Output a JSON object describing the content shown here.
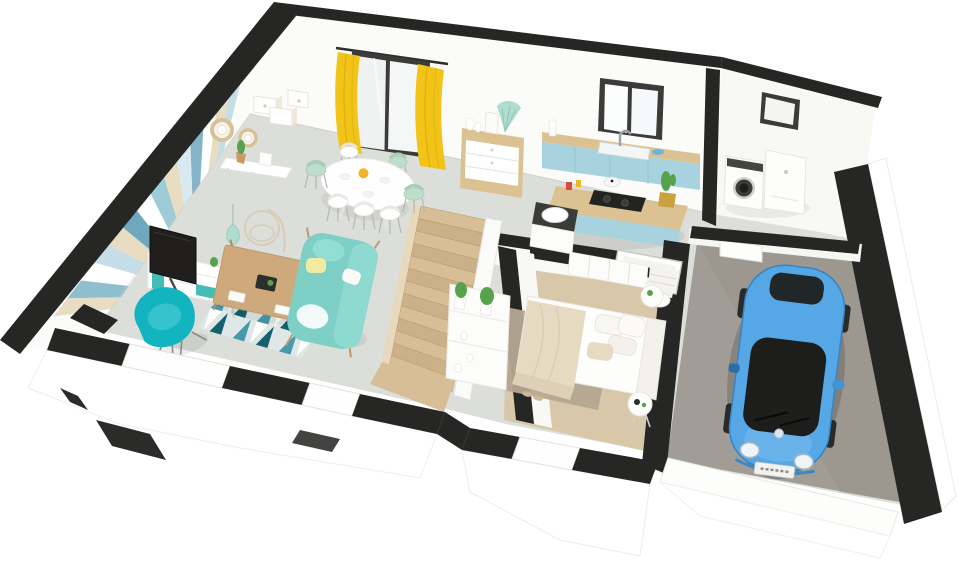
{
  "meta": {
    "description": "3D isometric cutaway rendering of a single-storey house floor plan with living room, dining area, kitchen, bathroom, bedroom, laundry room and garage with a blue car",
    "image_width": 960,
    "image_height": 576
  },
  "colors": {
    "wall": "#fbfbf9",
    "wallShade": "#f1f0ec",
    "cut": "#262624",
    "floorGray": "#dcdeda",
    "floorBeige": "#d8c8a9",
    "garageFloor": "#a19d96",
    "woodStairs": "#d8be96",
    "woodStairsAlt": "#cbb088",
    "woodCounter": "#dcc293",
    "woodTable": "#cda97c",
    "kitchenBlue": "#a8d3de",
    "tealAccent": "#45bdb6",
    "armchairTeal": "#12b4bf",
    "sofaAqua": "#7ed0c6",
    "rugDark": "#15616f",
    "rugMid": "#4899aa",
    "rugPale": "#dfe8e6",
    "curtainYellow": "#f3c418",
    "curtainShade": "#d8a90f",
    "carBlue": "#55a8e5",
    "carRoof": "#1d1d1b",
    "plantGreen": "#57a24d",
    "rattan": "#d9c196",
    "blanketBeige": "#e6dac2",
    "bedroomRug": "#b5a692",
    "frameDark": "#3b3b39",
    "mintDecor": "#aedcd1",
    "chairMint": "#bcdecb",
    "applianceWhite": "#fdfdfc"
  },
  "scene": {
    "rooms": [
      {
        "name": "living-room",
        "objects": [
          "chevron-accent-wall",
          "tv",
          "tv-stand",
          "teal-armchair",
          "aqua-sofa",
          "coffee-table",
          "geometric-rug",
          "hanging-chair",
          "pendant-lamp"
        ]
      },
      {
        "name": "dining-area",
        "objects": [
          "oval-table",
          "dining-chairs",
          "glass-door",
          "yellow-curtains",
          "sideboard",
          "wall-shelves",
          "wall-mirrors",
          "console-table"
        ]
      },
      {
        "name": "kitchen",
        "objects": [
          "window",
          "counter-with-sink",
          "island-with-cooktop",
          "cactus",
          "cooking-pot"
        ]
      },
      {
        "name": "bathroom",
        "objects": [
          "washbasin",
          "shower",
          "toilet"
        ]
      },
      {
        "name": "bedroom",
        "objects": [
          "double-bed",
          "bedroom-rug",
          "bedside-tables",
          "wardrobe",
          "hall-console-with-plants",
          "slippers"
        ]
      },
      {
        "name": "laundry-room",
        "objects": [
          "washing-machine",
          "dryer",
          "small-window",
          "service-door"
        ]
      },
      {
        "name": "garage",
        "objects": [
          "blue-car"
        ]
      },
      {
        "name": "staircase",
        "objects": [
          "wooden-stairs",
          "balustrade"
        ]
      }
    ],
    "wallpaper": {
      "stripe_colors": [
        "#c4dde6",
        "#e8dcc2",
        "#ffffff",
        "#85b4c8",
        "#d8eaf0",
        "#e8dcc2",
        "#9ecbd8",
        "#ffffff",
        "#6fa7bf",
        "#e8dcc2",
        "#c4dde6",
        "#ffffff",
        "#8fbfce",
        "#e8dcc2"
      ]
    },
    "rug_pattern": {
      "rows": 4,
      "cols": 9,
      "colors": [
        "#15616f",
        "#dfe8e6",
        "#4899aa",
        "#ffffff"
      ]
    },
    "stairs": {
      "steps": 13,
      "step_colors": [
        "#d8be96",
        "#cbb088"
      ]
    }
  }
}
